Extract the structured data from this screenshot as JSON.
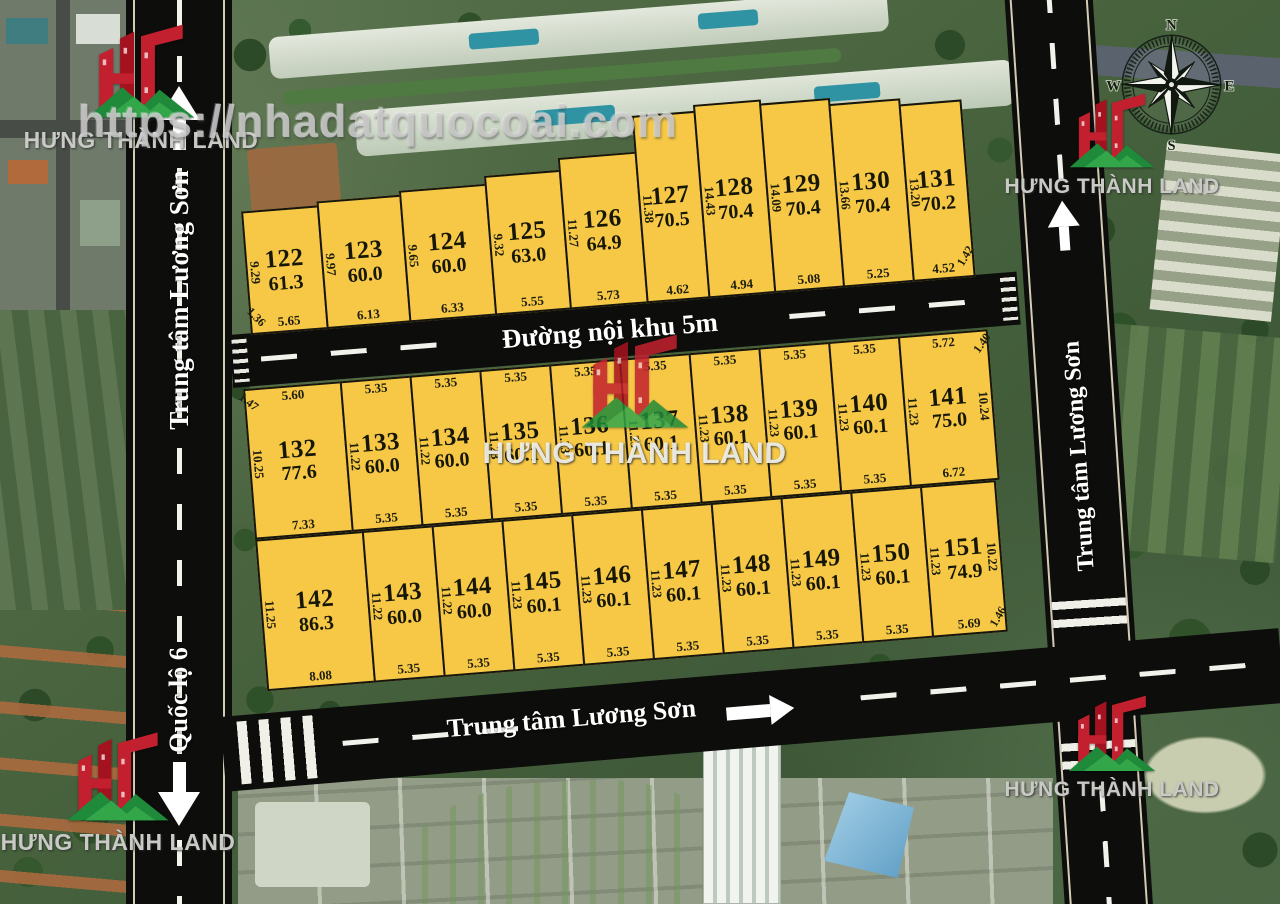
{
  "watermark": {
    "url": "https://nhadatquocoai.com"
  },
  "brand": {
    "name": "HƯNG THÀNH LAND"
  },
  "roads": {
    "inner_label": "Đường nội khu 5m",
    "left_upper_label": "Trung tâm Lương Sơn",
    "left_lower_label": "Quốc lộ 6",
    "right_label": "Trung tâm Lương Sơn",
    "bottom_label": "Trung tâm Lương Sơn"
  },
  "compass": {
    "north": "N",
    "east": "E",
    "south": "S",
    "west": "W"
  },
  "colors": {
    "plot_fill": "#F6C845",
    "plot_border": "#16160E",
    "road": "#0D0D0B",
    "road_text": "#FFFFFF",
    "logo_red": "#C2202E",
    "logo_green": "#1F8A3A",
    "arrow_purple": "#9A7BCE",
    "watermark_gray": "#CDCDCD"
  },
  "blocks": {
    "row1": {
      "corner_left": "1.36",
      "corner_right": "1.42",
      "plots": [
        {
          "id": "122",
          "area": "61.3",
          "side": "9.29",
          "bottom": "5.65"
        },
        {
          "id": "123",
          "area": "60.0",
          "side": "9.97",
          "bottom": "6.13"
        },
        {
          "id": "124",
          "area": "60.0",
          "side": "9.65",
          "bottom": "6.33"
        },
        {
          "id": "125",
          "area": "63.0",
          "side": "9.32",
          "bottom": "5.55"
        },
        {
          "id": "126",
          "area": "64.9",
          "side": "11.27",
          "bottom": "5.73"
        },
        {
          "id": "127",
          "area": "70.5",
          "side": "11.38",
          "bottom": "4.62"
        },
        {
          "id": "128",
          "area": "70.4",
          "side": "14.43",
          "bottom": "4.94"
        },
        {
          "id": "129",
          "area": "70.4",
          "side": "14.09",
          "bottom": "5.08"
        },
        {
          "id": "130",
          "area": "70.4",
          "side": "13.66",
          "bottom": "5.25"
        },
        {
          "id": "131",
          "area": "70.2",
          "side": "13.20",
          "bottom": "4.52"
        }
      ]
    },
    "row2": {
      "corner_left": "1.47",
      "corner_right": "1.40",
      "right_side": "10.24",
      "plots": [
        {
          "id": "132",
          "area": "77.6",
          "side": "10.25",
          "top": "5.60",
          "bottom": "7.33"
        },
        {
          "id": "133",
          "area": "60.0",
          "side": "11.22",
          "top": "5.35",
          "bottom": "5.35"
        },
        {
          "id": "134",
          "area": "60.0",
          "side": "11.22",
          "top": "5.35",
          "bottom": "5.35"
        },
        {
          "id": "135",
          "area": "60.1",
          "side": "11.23",
          "top": "5.35",
          "bottom": "5.35"
        },
        {
          "id": "136",
          "area": "60.1",
          "side": "11.23",
          "top": "5.35",
          "bottom": "5.35"
        },
        {
          "id": "137",
          "area": "60.1",
          "side": "11.23",
          "top": "5.35",
          "bottom": "5.35"
        },
        {
          "id": "138",
          "area": "60.1",
          "side": "11.23",
          "top": "5.35",
          "bottom": "5.35"
        },
        {
          "id": "139",
          "area": "60.1",
          "side": "11.23",
          "top": "5.35",
          "bottom": "5.35"
        },
        {
          "id": "140",
          "area": "60.1",
          "side": "11.23",
          "top": "5.35",
          "bottom": "5.35"
        },
        {
          "id": "141",
          "area": "75.0",
          "side": "11.23",
          "top": "5.72",
          "bottom": "6.72"
        }
      ]
    },
    "row3": {
      "corner_right": "1.46",
      "right_side": "10.22",
      "plots": [
        {
          "id": "142",
          "area": "86.3",
          "side": "11.25",
          "bottom": "8.08"
        },
        {
          "id": "143",
          "area": "60.0",
          "side": "11.22",
          "bottom": "5.35"
        },
        {
          "id": "144",
          "area": "60.0",
          "side": "11.22",
          "bottom": "5.35"
        },
        {
          "id": "145",
          "area": "60.1",
          "side": "11.23",
          "bottom": "5.35"
        },
        {
          "id": "146",
          "area": "60.1",
          "side": "11.23",
          "bottom": "5.35"
        },
        {
          "id": "147",
          "area": "60.1",
          "side": "11.23",
          "bottom": "5.35"
        },
        {
          "id": "148",
          "area": "60.1",
          "side": "11.23",
          "bottom": "5.35"
        },
        {
          "id": "149",
          "area": "60.1",
          "side": "11.23",
          "bottom": "5.35"
        },
        {
          "id": "150",
          "area": "60.1",
          "side": "11.23",
          "bottom": "5.35"
        },
        {
          "id": "151",
          "area": "74.9",
          "side": "11.23",
          "bottom": "5.69"
        }
      ]
    }
  }
}
